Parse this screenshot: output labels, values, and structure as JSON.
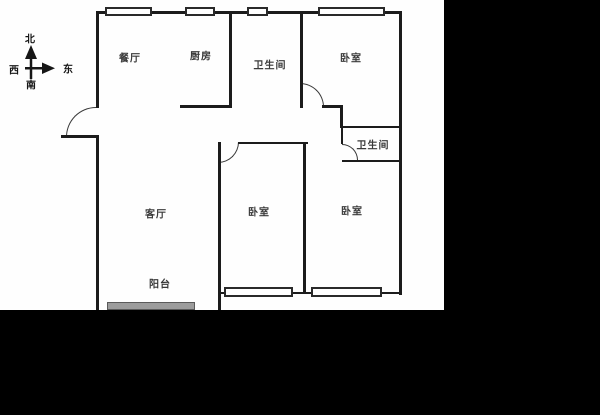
{
  "canvas": {
    "width": 600,
    "height": 415,
    "background": "#000000"
  },
  "plan_area": {
    "x": 0,
    "y": 0,
    "width": 444,
    "height": 310,
    "background": "#fefefe"
  },
  "colors": {
    "wall": "#1c1c1c",
    "window_border": "#2a2a2a",
    "window_fill": "#ffffff",
    "balcony_window_fill": "#9c9c9c",
    "label_text": "#3a3a3a"
  },
  "compass": {
    "north": "北",
    "south": "南",
    "west": "西",
    "east": "东"
  },
  "rooms": [
    {
      "id": "dining",
      "label": "餐厅",
      "x": 130,
      "y": 57
    },
    {
      "id": "kitchen",
      "label": "厨房",
      "x": 201,
      "y": 55
    },
    {
      "id": "bathroom-1",
      "label": "卫生间",
      "x": 270,
      "y": 64
    },
    {
      "id": "bedroom-north",
      "label": "卧室",
      "x": 351,
      "y": 57
    },
    {
      "id": "living",
      "label": "客厅",
      "x": 156,
      "y": 213
    },
    {
      "id": "bedroom-mid",
      "label": "卧室",
      "x": 259,
      "y": 211
    },
    {
      "id": "bedroom-east",
      "label": "卧室",
      "x": 352,
      "y": 210
    },
    {
      "id": "bathroom-2",
      "label": "卫生间",
      "x": 373,
      "y": 144
    },
    {
      "id": "balcony",
      "label": "阳台",
      "x": 160,
      "y": 283
    }
  ],
  "geometry": {
    "walls": [
      [
        96,
        11,
        306,
        3
      ],
      [
        96,
        11,
        3,
        97
      ],
      [
        61,
        135,
        36,
        3
      ],
      [
        96,
        135,
        3,
        175
      ],
      [
        399,
        11,
        3,
        284
      ],
      [
        229,
        11,
        3,
        97
      ],
      [
        180,
        105,
        52,
        3
      ],
      [
        300,
        11,
        3,
        97
      ],
      [
        322,
        105,
        20,
        3
      ],
      [
        340,
        105,
        3,
        23
      ],
      [
        340,
        126,
        62,
        2
      ],
      [
        341,
        126,
        2,
        18
      ],
      [
        342,
        160,
        60,
        2
      ],
      [
        238,
        142,
        70,
        2
      ],
      [
        218,
        142,
        3,
        168
      ],
      [
        303,
        142,
        3,
        152
      ],
      [
        218,
        292,
        88,
        2
      ],
      [
        303,
        292,
        99,
        2
      ]
    ],
    "windows": [
      {
        "x": 105,
        "y": 7,
        "w": 47,
        "h": 9,
        "type": "white"
      },
      {
        "x": 185,
        "y": 7,
        "w": 30,
        "h": 9,
        "type": "white"
      },
      {
        "x": 247,
        "y": 7,
        "w": 21,
        "h": 9,
        "type": "white"
      },
      {
        "x": 318,
        "y": 7,
        "w": 67,
        "h": 9,
        "type": "white"
      },
      {
        "x": 224,
        "y": 287,
        "w": 69,
        "h": 10,
        "type": "white"
      },
      {
        "x": 311,
        "y": 287,
        "w": 71,
        "h": 10,
        "type": "white"
      },
      {
        "x": 107,
        "y": 302,
        "w": 88,
        "h": 8,
        "type": "gray"
      }
    ],
    "door_arcs": [
      {
        "x": 66,
        "y": 107,
        "w": 30,
        "h": 30,
        "corner": "tl"
      },
      {
        "x": 300,
        "y": 83,
        "w": 24,
        "h": 24,
        "corner": "tr"
      },
      {
        "x": 218,
        "y": 142,
        "w": 21,
        "h": 21,
        "corner": "br"
      },
      {
        "x": 342,
        "y": 144,
        "w": 16,
        "h": 16,
        "corner": "tr"
      }
    ]
  }
}
